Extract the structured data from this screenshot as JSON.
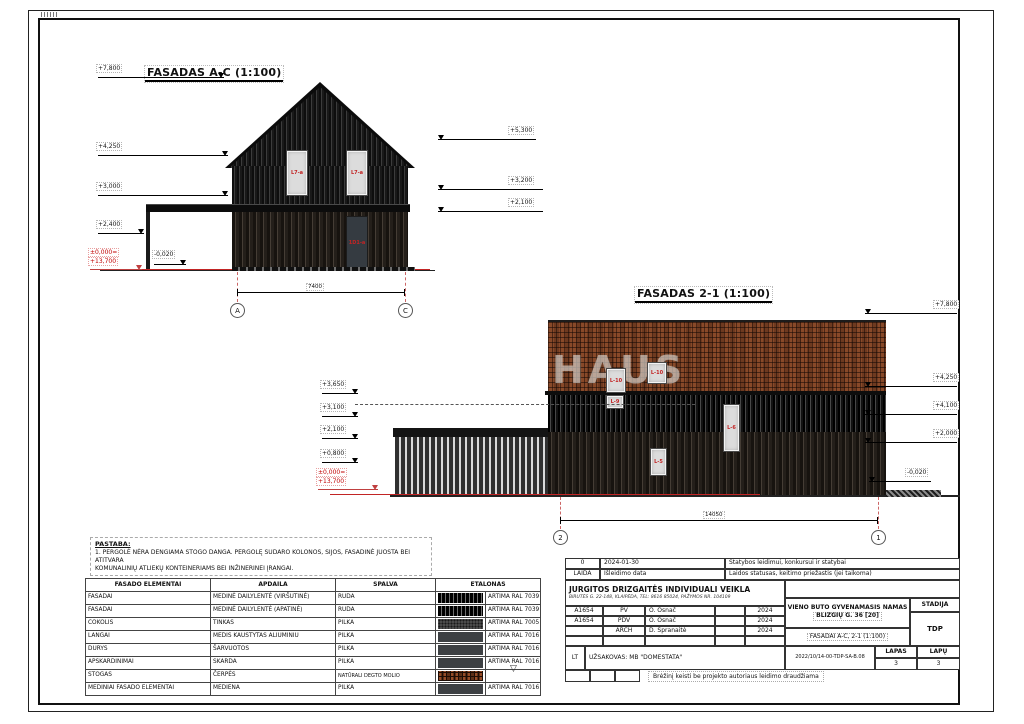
{
  "sheet": {
    "watermark": "HAUS"
  },
  "facade_ac": {
    "title": "FASADAS A-C (1:100)",
    "left_marks": [
      "+7,800",
      "+4,250",
      "+3,000",
      "+2,400"
    ],
    "zero_mark": "±0,000=",
    "zero_alt": "+13,700",
    "minus_mark": "-0,020",
    "right_marks": [
      "+5,300",
      "+3,200",
      "+2,100"
    ],
    "dim": "7400",
    "axis_left": "A",
    "axis_right": "C",
    "window_tag": "L7-a",
    "door_tag": "1D1-a"
  },
  "facade_21": {
    "title": "FASADAS 2-1 (1:100)",
    "left_marks": [
      "+3,650",
      "+3,100",
      "+2,100",
      "+0,800"
    ],
    "zero_mark": "±0,000=",
    "zero_alt": "+13,700",
    "minus_mark": "-0,020",
    "right_marks": [
      "+7,800",
      "+4,250",
      "+4,100",
      "+2,000"
    ],
    "dim": "14050",
    "axis_left": "2",
    "axis_right": "1",
    "window_tags": [
      "L-10",
      "L-10",
      "L-9",
      "L-6",
      "L-5"
    ]
  },
  "note": {
    "title": "PASTABA:",
    "line1": "1. PERGOLĖ NĖRA DENGIAMA STOGO DANGA. PERGOLĘ SUDARO KOLONOS, SIJOS, FASADINĖ JUOSTA BEI ATITVARA",
    "line2": "KOMUNALINIŲ ATLIEKŲ KONTEINERIAMS BEI INŽINERINEI ĮRANGAI."
  },
  "materials": {
    "headers": [
      "FASADO ELEMENTAI",
      "APDAILA",
      "SPALVA",
      "ETALONAS"
    ],
    "rows": [
      {
        "element": "FASADAI",
        "apdaila": "MEDINĖ DAILYLENTĖ (VIRŠUTINĖ)",
        "spalva": "RUDA",
        "swatch": "wood-dark",
        "ral": "ARTIMA RAL 7039"
      },
      {
        "element": "FASADAI",
        "apdaila": "MEDINĖ DAILYLENTĖ (APATINĖ)",
        "spalva": "RUDA",
        "swatch": "wood-dark",
        "ral": "ARTIMA RAL 7039"
      },
      {
        "element": "COKOLIS",
        "apdaila": "TINKAS",
        "spalva": "PILKA",
        "swatch": "stucco",
        "ral": "ARTIMA RAL 7005"
      },
      {
        "element": "LANGAI",
        "apdaila": "MEDIS KAUSTYTAS ALIUMINIU",
        "spalva": "PILKA",
        "swatch": "solid",
        "ral": "ARTIMA RAL 7016"
      },
      {
        "element": "DURYS",
        "apdaila": "ŠARVUOTOS",
        "spalva": "PILKA",
        "swatch": "solid",
        "ral": "ARTIMA RAL 7016"
      },
      {
        "element": "APSKARDINIMAI",
        "apdaila": "SKARDA",
        "spalva": "PILKA",
        "swatch": "solid",
        "ral": "ARTIMA RAL 7016"
      },
      {
        "element": "STOGAS",
        "apdaila": "ČERPĖS",
        "spalva": "NATŪRALI DEGTO MOLIO",
        "swatch": "tile",
        "ral": ""
      },
      {
        "element": "MEDINIAI FASADO ELEMENTAI",
        "apdaila": "MEDIENA",
        "spalva": "PILKA",
        "swatch": "solid",
        "ral": "ARTIMA RAL 7016"
      }
    ]
  },
  "titleblock": {
    "rev_no": "0",
    "rev_date": "2024-01-30",
    "rev_status": "Statybos leidimui, konkursui ir statybai",
    "laida_label": "LAIDA",
    "date_label": "Išleidimo data",
    "status_label": "Laidos statusas, keitimo priežastis (jei taikoma)",
    "company": "JURGITOS DRIZGAITĖS INDIVIDUALI VEIKLA",
    "company_info": "BIRUTĖS G. 22-148, KLAIPĖDA, TEL: 8616 85024, PAŽYMOS NR. 104109",
    "approvals": [
      {
        "cert": "A1654",
        "role": "PV",
        "name": "O. Osnač",
        "year": "2024"
      },
      {
        "cert": "A1654",
        "role": "PDV",
        "name": "O. Osnač",
        "year": "2024"
      },
      {
        "cert": "",
        "role": "ARCH",
        "name": "D. Spranaitė",
        "year": "2024"
      }
    ],
    "object_line1": "VIENO BUTO GYVENAMASIS NAMAS",
    "object_line2": "BLIZGIŲ G. 36 [20]",
    "drawing_title": "FASADAI A-C, 2-1 (1:100)",
    "stadija_label": "STADIJA",
    "stadija_value": "TDP",
    "lang": "LT",
    "client": "UŽSAKOVAS: MB \"DOMESTATA\"",
    "doc_no": "2022/10/14-00-TDP-SA-B.08",
    "lapas_label": "LAPAS",
    "lapas_value": "3",
    "lapu_label": "LAPŲ",
    "lapu_value": "3",
    "edit_note": "Brėžinį keisti be projekto autoriaus leidimo draudžiama"
  }
}
